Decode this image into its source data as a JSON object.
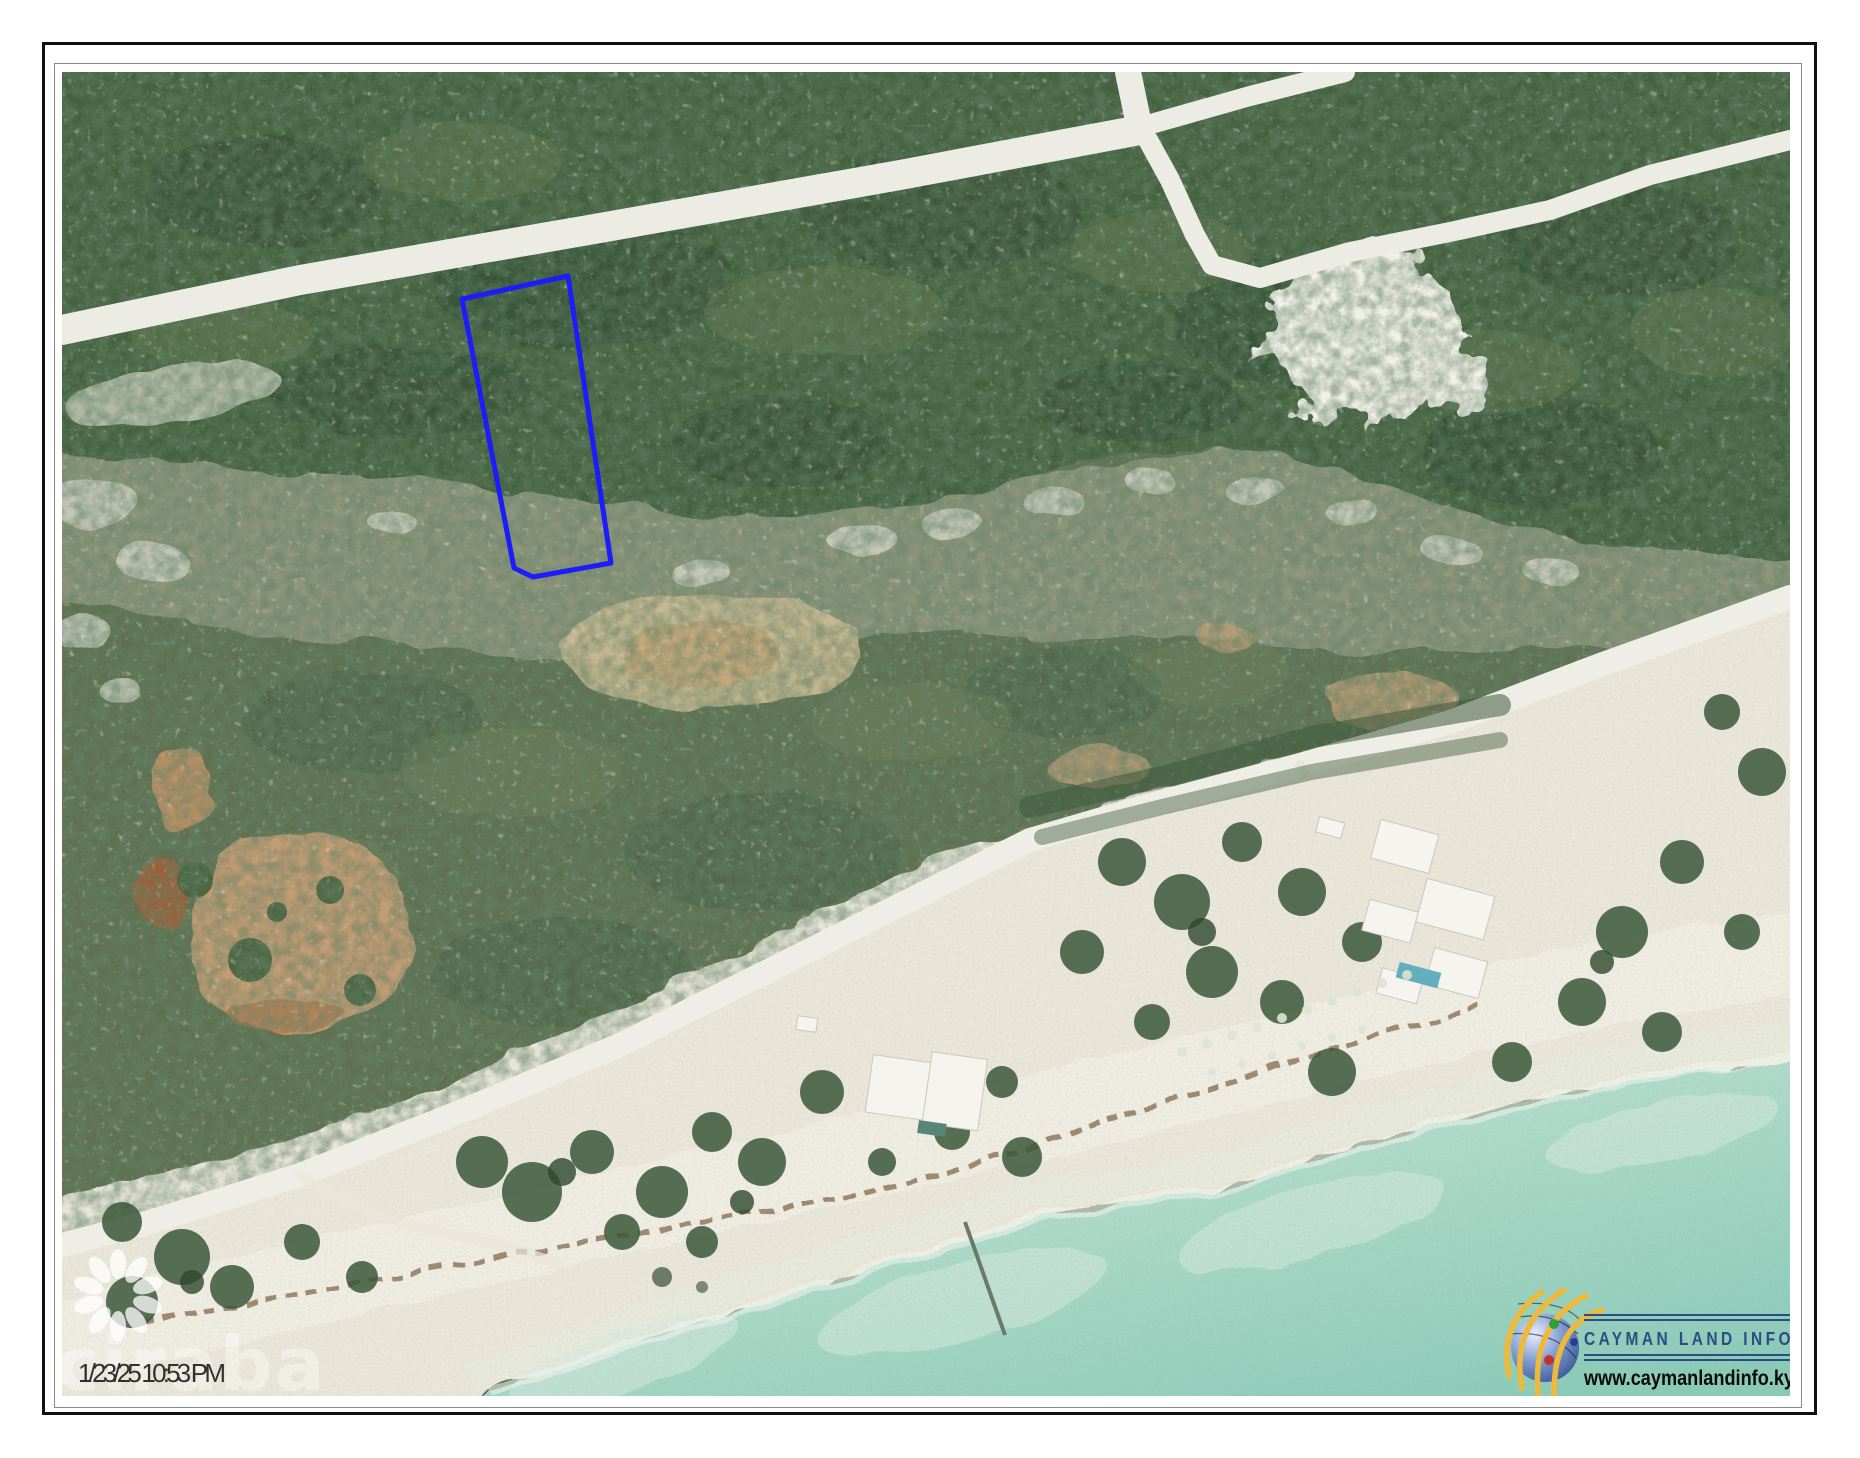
{
  "page": {
    "background": "#ffffff",
    "outer_border_color": "#111111",
    "inner_border_color": "#8a8a8a"
  },
  "map": {
    "kind": "aerial-imagery",
    "timestamp": "1/23/25 10:53 PM",
    "watermark": {
      "text": "ciraba",
      "icon": "flower-petal-rosette"
    },
    "parcel_boundary": {
      "color": "#1d1dfa",
      "points": "400,227 506,204 549,491 471,505 452,496"
    },
    "palette": {
      "forest": "#43603e",
      "scrub": "#8d957a",
      "mid_vegetation": "#5e7050",
      "sand": "#ebe8db",
      "road": "#edece4",
      "pond_tan": "#c59c72",
      "pond_rust": "#9a6137",
      "ocean_shallow": "#d6ebdf",
      "ocean_deep": "#8accb9"
    },
    "features": [
      "forest",
      "dirt-roads",
      "rock-scrub-band",
      "ponds",
      "beach",
      "ocean",
      "buildings",
      "pier"
    ]
  },
  "branding": {
    "logo_title": "CAYMAN LAND INFO",
    "logo_url": "www.caymanlandinfo.ky",
    "title_color": "#2c4c82",
    "url_color": "#0b0b0b",
    "globe_icon": "globe-with-orbit-arcs"
  }
}
